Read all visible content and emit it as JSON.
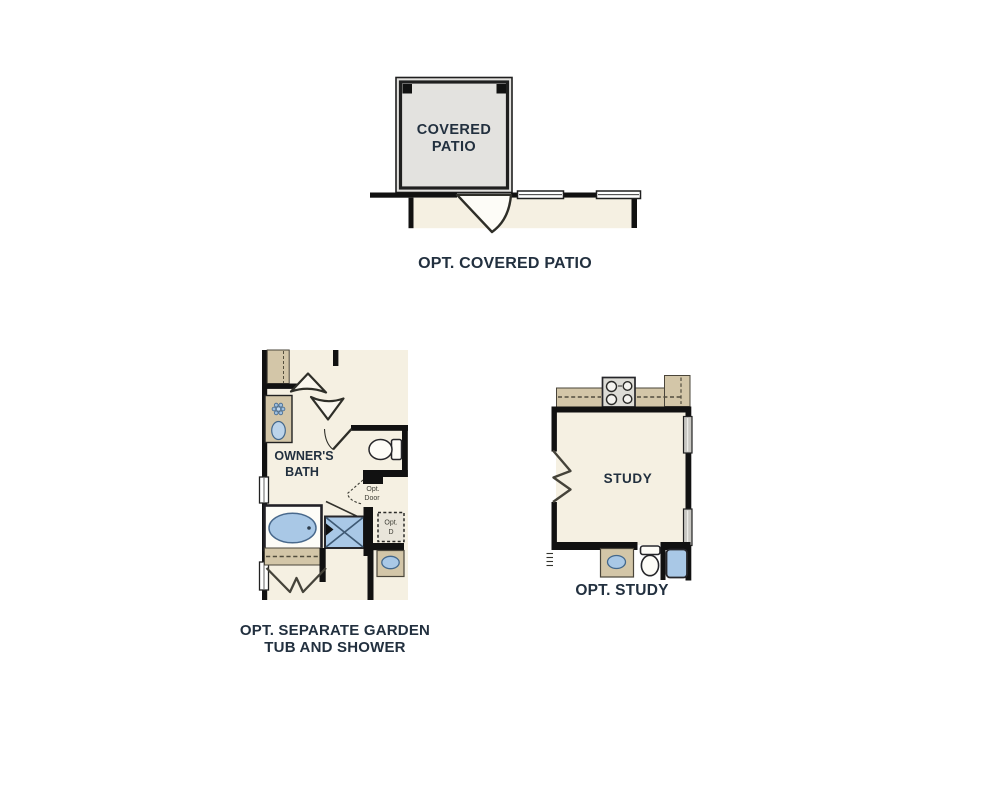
{
  "canvas": {
    "width": 1000,
    "height": 810,
    "background": "#ffffff"
  },
  "palette": {
    "wall": "#181818",
    "interior_fill": "#f5f0e2",
    "cabinet_fill": "#d3c6a8",
    "patio_fill": "#e3e2df",
    "fixture_blue": "#a9c8e6",
    "fixture_white": "#fdfcf7",
    "label_color": "#22303f"
  },
  "figures": {
    "covered_patio": {
      "room_label": [
        "COVERED",
        "PATIO"
      ],
      "caption": "OPT. COVERED PATIO"
    },
    "owners_bath": {
      "room_label": [
        "OWNER'S",
        "BATH"
      ],
      "opt_door_label": [
        "Opt.",
        "Door"
      ],
      "opt_dryer_label": [
        "Opt.",
        "D"
      ],
      "caption_line1": "OPT. SEPARATE GARDEN",
      "caption_line2": "TUB AND SHOWER"
    },
    "study": {
      "room_label": "STUDY",
      "caption": "OPT. STUDY"
    }
  }
}
